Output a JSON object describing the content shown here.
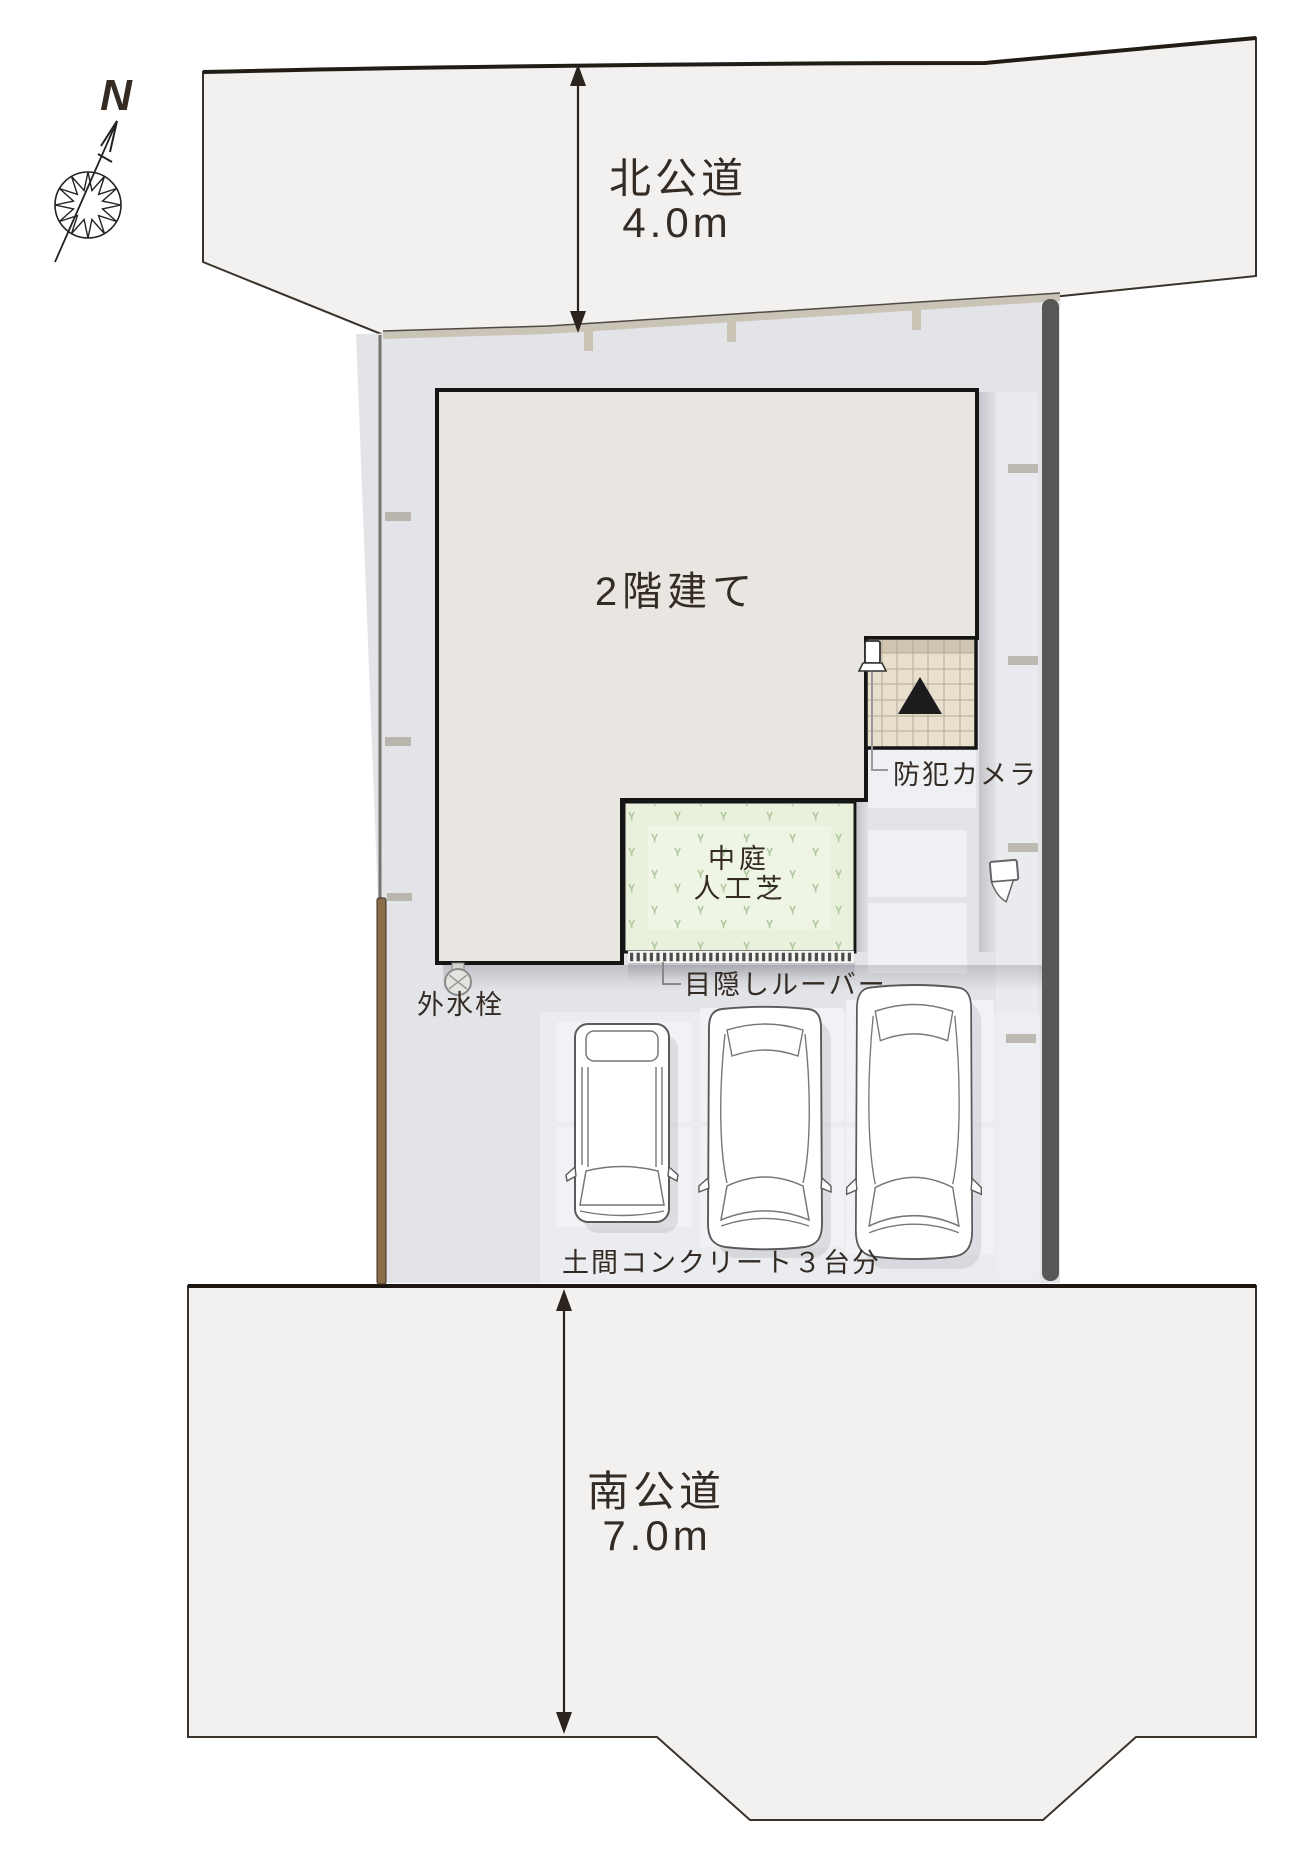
{
  "compass": {
    "north_label": "N"
  },
  "north_road": {
    "name": "北公道",
    "width": "4.0m"
  },
  "south_road": {
    "name": "南公道",
    "width": "7.0m"
  },
  "site": {
    "building_label": "2階建て",
    "security_camera_label": "防犯カメラ",
    "courtyard_label_line1": "中庭",
    "courtyard_label_line2": "人工芝",
    "louver_label": "目隠しルーバー",
    "water_tap_label": "外水栓",
    "parking_label": "土間コンクリート３台分"
  },
  "colors": {
    "road_fill": "#f2f1ef",
    "lot_fill": "#e3e4e8",
    "paving_light": "#eef0f3",
    "parking_slab": "#eaecef",
    "stall_tile": "#f1f2f5",
    "building_fill": "#e9e5e1",
    "porch_tile": "#e8dfcd",
    "courtyard_fill": "#e9f1dc",
    "east_fence": "#575757",
    "north_fence": "#c9c4b6",
    "wood_fence": "#8a6e4b",
    "line_dark": "#2b241e",
    "text": "#342b24"
  }
}
